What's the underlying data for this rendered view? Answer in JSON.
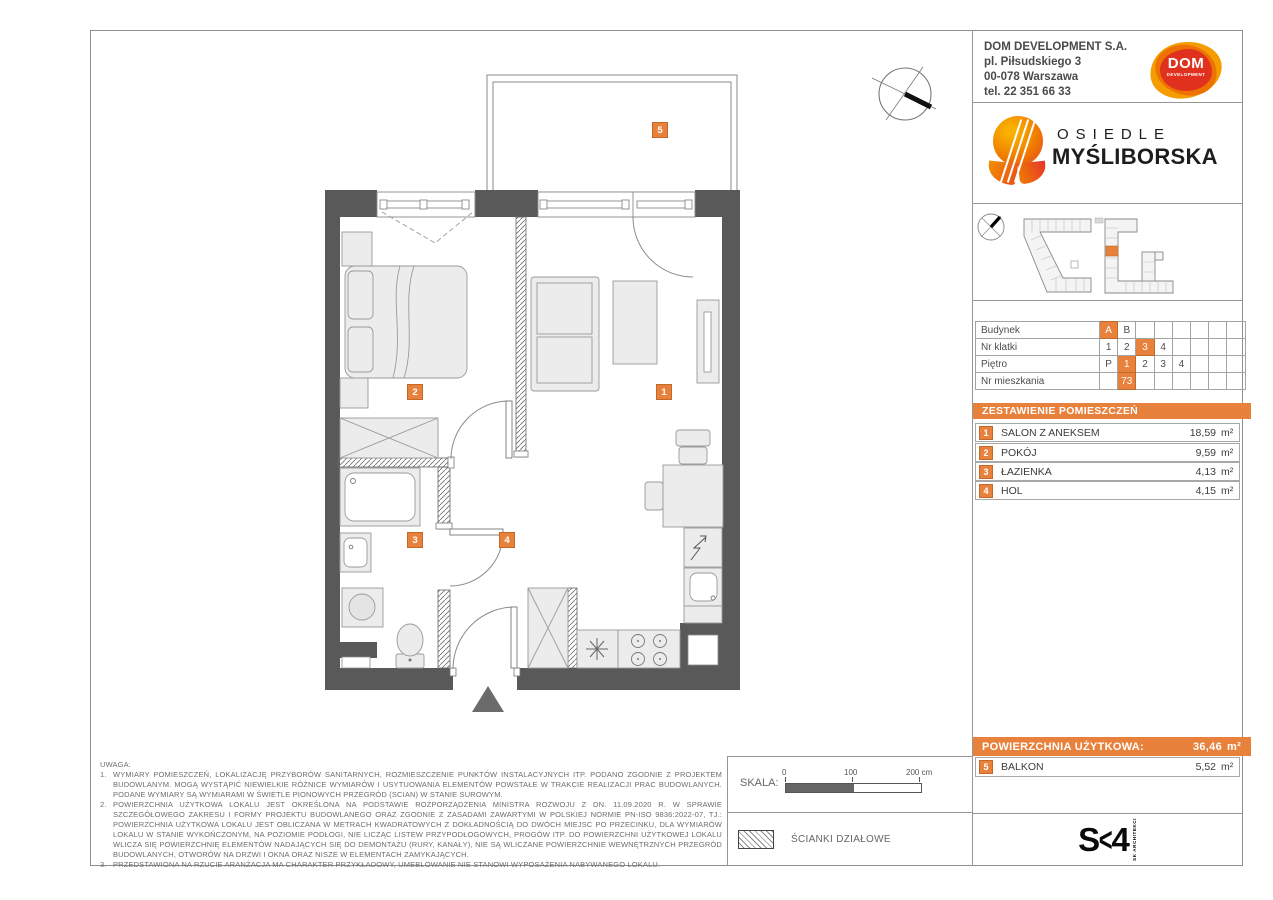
{
  "developer": {
    "name": "DOM DEVELOPMENT S.A.",
    "address1": "pl. Piłsudskiego 3",
    "address2": "00-078 Warszawa",
    "phone": "tel. 22 351 66 33",
    "logo": {
      "main": "DOM",
      "sub": "DEVELOPMENT"
    }
  },
  "estate": {
    "line1": "OSIEDLE",
    "line2": "MYŚLIBORSKA"
  },
  "unit_info": {
    "rows": [
      {
        "label": "Budynek",
        "cells": [
          "A",
          "B",
          "",
          "",
          "",
          "",
          "",
          ""
        ],
        "highlighted_value": "A"
      },
      {
        "label": "Nr klatki",
        "cells": [
          "1",
          "2",
          "3",
          "4",
          "",
          "",
          "",
          ""
        ],
        "highlighted_value": "3"
      },
      {
        "label": "Piętro",
        "cells": [
          "P",
          "1",
          "2",
          "3",
          "4",
          "",
          "",
          ""
        ],
        "highlighted_value": "1"
      },
      {
        "label": "Nr mieszkania",
        "cells": [
          "",
          "73",
          "",
          "",
          "",
          "",
          "",
          ""
        ],
        "highlighted_value": "73"
      }
    ]
  },
  "room_schedule": {
    "title": "ZESTAWIENIE POMIESZCZEŃ",
    "unit": "m²",
    "rooms": [
      {
        "id": "1",
        "name": "SALON Z ANEKSEM",
        "area": "18,59"
      },
      {
        "id": "2",
        "name": "POKÓJ",
        "area": "9,59"
      },
      {
        "id": "3",
        "name": "ŁAZIENKA",
        "area": "4,13"
      },
      {
        "id": "4",
        "name": "HOL",
        "area": "4,15"
      }
    ],
    "total_label": "POWIERZCHNIA UŻYTKOWA:",
    "total_area": "36,46",
    "balcony": {
      "id": "5",
      "name": "BALKON",
      "area": "5,52"
    }
  },
  "notes": {
    "title": "UWAGA:",
    "items": [
      {
        "num": "1.",
        "text": "WYMIARY POMIESZCZEŃ, LOKALIZACJĘ PRZYBORÓW SANITARNYCH, ROZMIESZCZENIE PUNKTÓW INSTALACYJNYCH ITP. PODANO ZGODNIE Z PROJEKTEM BUDOWLANYM. MOGĄ WYSTĄPIĆ NIEWIELKIE RÓŻNICE WYMIARÓW I USYTUOWANIA ELEMENTÓW POWSTAŁE W TRAKCIE REALIZACJI PRAC BUDOWLANYCH. PODANE WYMIARY SĄ WYMIARAMI W ŚWIETLE PIONOWYCH PRZEGRÓD (SCIAN) W STANIE SUROWYM."
      },
      {
        "num": "2.",
        "text": "POWIERZCHNIA UŻYTKOWA LOKALU JEST OKREŚLONA NA PODSTAWIE ROZPORZĄDZENIA MINISTRA ROZWOJU Z DN. 11.09.2020 R. W SPRAWIE SZCZEGÓŁOWEGO ZAKRESU I FORMY PROJEKTU BUDOWLANEGO ORAZ ZGODNIE Z ZASADAMI ZAWARTYMI W POLSKIEJ NORMIE PN-ISO 9836:2022-07, TJ.: POWIERZCHNIA UŻYTKOWA LOKALU JEST OBLICZANA W METRACH KWADRATOWYCH Z DOKŁADNOŚCIĄ DO DWÓCH MIEJSC PO PRZECINKU, DLA WYMIARÓW LOKALU W STANIE WYKOŃCZONYM, NA POZIOMIE PODŁOGI, NIE LICZĄC LISTEW PRZYPODŁOGOWYCH, PROGÓW ITP. DO POWIERZCHNI UŻYTKOWEJ LOKALU WLICZA SIĘ POWIERZCHNIĘ ELEMENTÓW NADAJĄCYCH SIĘ DO DEMONTAŻU (RURY, KANAŁY), NIE SĄ WLICZANE POWIERZCHNIE WEWNĘTRZNYCH PRZEGRÓD BUDOWLANYCH, OTWORÓW NA DRZWI I OKNA ORAZ NISZE W ELEMENTACH ZAMYKAJĄCYCH."
      },
      {
        "num": "3.",
        "text": "PRZEDSTAWIONA NA RZUCIE ARANŻACJA MA CHARAKTER PRZYKŁADOWY, UMEBLOWANIE NIE STANOWI WYPOSAŻENIA NABYWANEGO LOKALU."
      }
    ]
  },
  "scale": {
    "label": "SKALA:",
    "ticks": [
      "0",
      "100",
      "200 cm"
    ]
  },
  "legend": {
    "partition_label": "ŚCIANKI DZIAŁOWE"
  },
  "architect": {
    "logo_s": "S",
    "logo_k": "<",
    "logo_4": "4",
    "caption": "SK ARCHITEKCI"
  },
  "colors": {
    "accent_orange": "#E8813B",
    "wall_gray": "#595959"
  }
}
